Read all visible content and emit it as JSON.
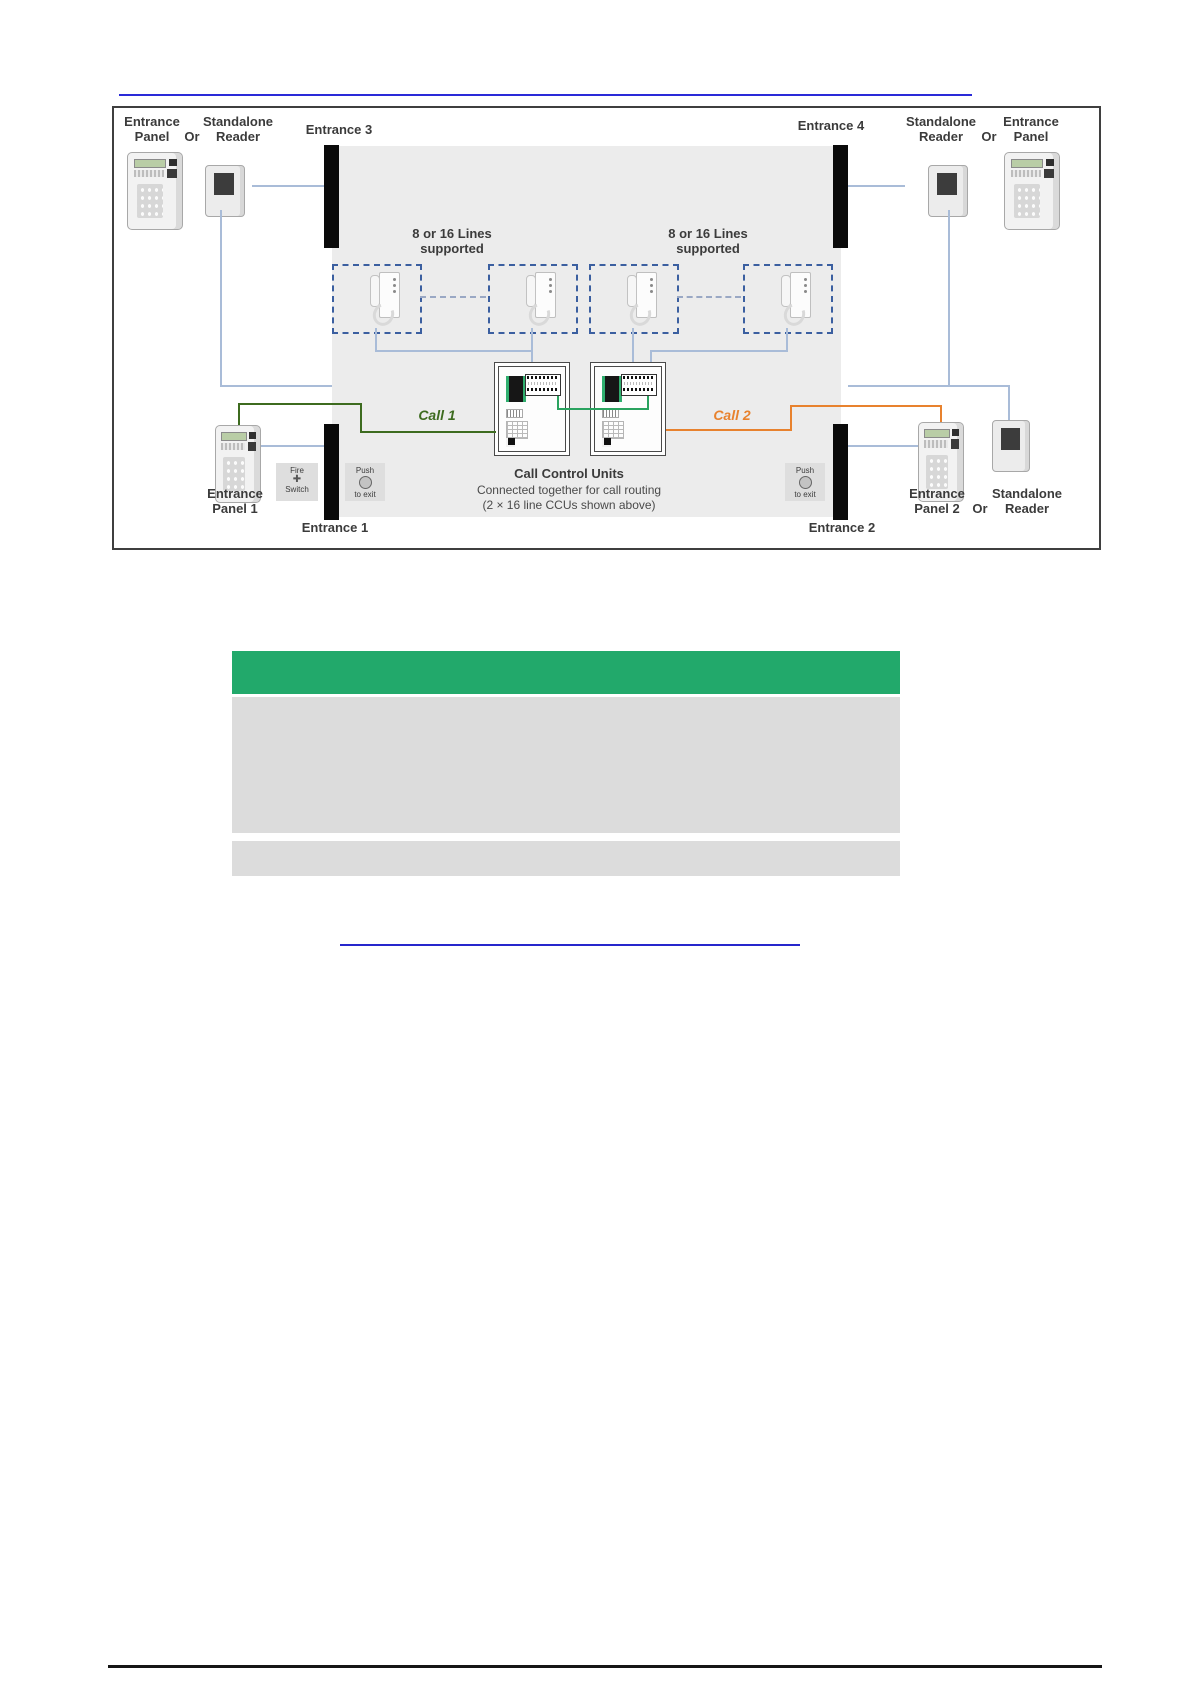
{
  "diagram": {
    "labels": {
      "entrance": "Entrance",
      "panel": "Panel",
      "or": "Or",
      "standalone": "Standalone",
      "reader": "Reader",
      "panel_1": "Panel 1",
      "panel_2": "Panel 2",
      "entrance_1": "Entrance 1",
      "entrance_2": "Entrance 2",
      "entrance_3": "Entrance 3",
      "entrance_4": "Entrance 4",
      "lines_supported_1": "8 or 16 Lines",
      "lines_supported_2": "supported",
      "call_1": "Call 1",
      "call_2": "Call 2",
      "ccu_title": "Call Control Units",
      "ccu_subtitle_1": "Connected together for call routing",
      "ccu_subtitle_2": "(2 × 16 line CCUs shown above)",
      "fire_switch_1": "Fire",
      "fire_switch_2": "Switch",
      "push_exit_1": "Push",
      "push_exit_2": "to exit"
    },
    "colors": {
      "call_1_line": "#3d6b1f",
      "call_2_line": "#e8822e",
      "ccu_link_green": "#2aa35f",
      "wire_blue": "#a9bcd8",
      "wall_black": "#0a0a0a",
      "building_gray": "#ececec",
      "dashed_box_blue": "#3b5fa0",
      "top_rule_blue": "#2a2ad8"
    }
  },
  "table": {
    "header_color": "#22a96b",
    "row_color": "#dcdcdc",
    "header_text": "",
    "rows": [
      "",
      ""
    ]
  },
  "link": {
    "text": "",
    "color": "#2626cc"
  }
}
